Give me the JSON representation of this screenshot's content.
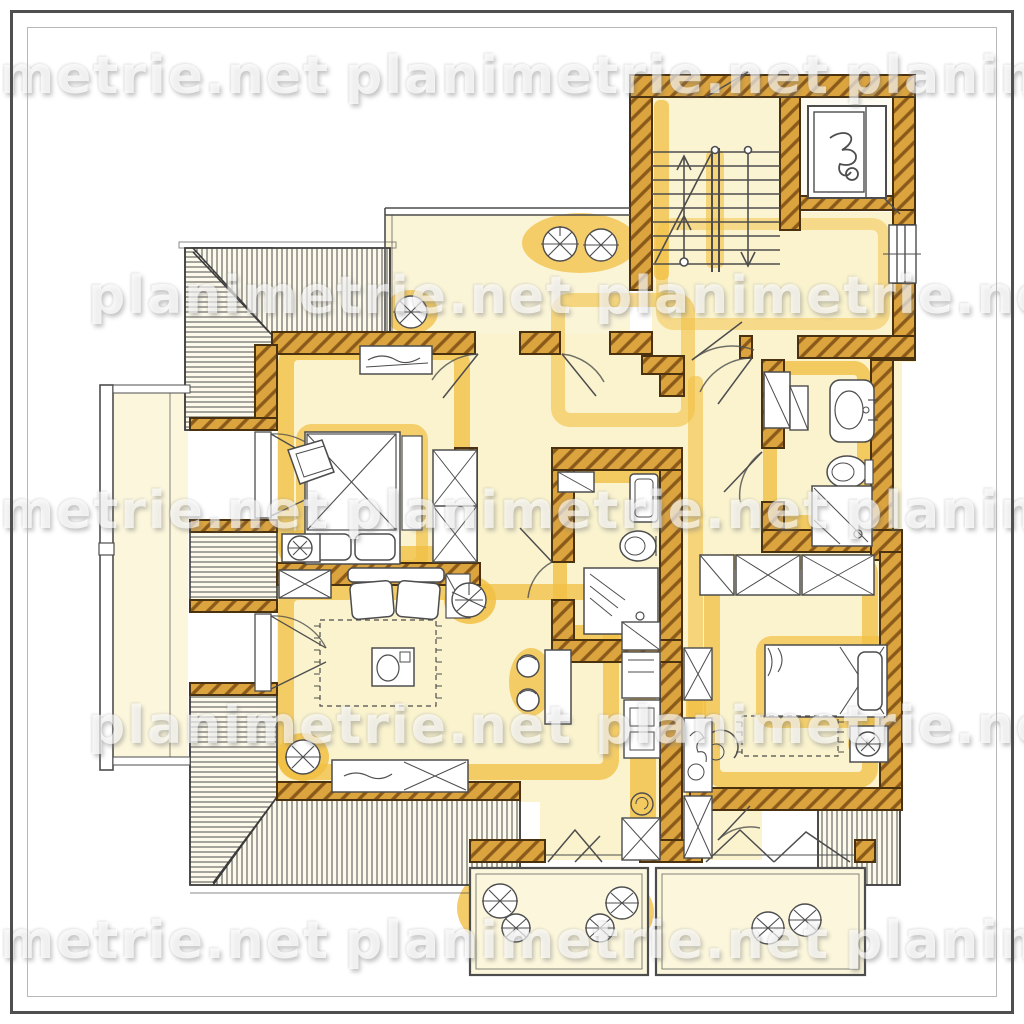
{
  "watermark": {
    "text": "planimetrie.net"
  },
  "palette": {
    "wall_fill": "#DCA43E",
    "wall_hatch": "#8A5A1B",
    "wall_outline": "#4A3210",
    "accent_yellow": "#F1BF43",
    "room_fill": "#FAF3CE",
    "terrace_fill": "#FBF5D8",
    "roof_hatch_bg": "#FDFAEB",
    "drawing_line": "#4d4d4d",
    "watermark_gray": "#8F8F8F",
    "paper": "#FFFFFF"
  },
  "icons": [
    "plant-icon",
    "potted-plant-icon",
    "stair-up-arrow-icon",
    "stair-down-arrow-icon",
    "elevator-symbol-icon",
    "toilet-icon",
    "sink-icon",
    "shower-icon",
    "bed-icon",
    "wardrobe-icon",
    "rug-icon",
    "sofa-icon",
    "dining-table-icon",
    "kitchen-counter-icon",
    "door-swing-icon",
    "roof-slope-hatch",
    "balcony-railing"
  ]
}
